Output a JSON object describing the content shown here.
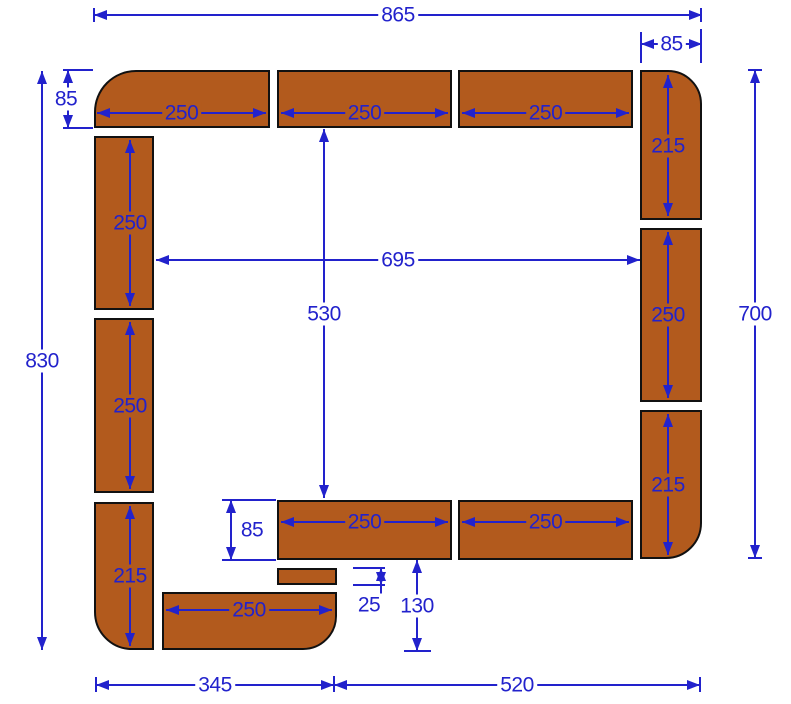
{
  "diagram": {
    "description": "Dimensioned cutting/layout plan of rectangular edging pieces forming an open rectangular border",
    "canvas": {
      "width": 791,
      "height": 704,
      "background": "#ffffff"
    },
    "colors": {
      "piece_fill": "#b25a1d",
      "piece_border": "#111111",
      "dimension": "#2222cc",
      "background": "#ffffff"
    },
    "pieces": [
      {
        "id": "top-left-corner-piece",
        "x": 94,
        "y": 70,
        "w": 176,
        "h": 58,
        "corner": "tl",
        "r": 42
      },
      {
        "id": "top-piece-1",
        "x": 277,
        "y": 70,
        "w": 175,
        "h": 58,
        "corner": "",
        "r": 0
      },
      {
        "id": "top-piece-2",
        "x": 458,
        "y": 70,
        "w": 175,
        "h": 58,
        "corner": "",
        "r": 0
      },
      {
        "id": "right-top-corner-piece",
        "x": 640,
        "y": 70,
        "w": 62,
        "h": 150,
        "corner": "tr",
        "r": 34
      },
      {
        "id": "right-middle-piece",
        "x": 640,
        "y": 228,
        "w": 62,
        "h": 174,
        "corner": "",
        "r": 0
      },
      {
        "id": "right-bottom-corner-piece",
        "x": 640,
        "y": 410,
        "w": 62,
        "h": 149,
        "corner": "br",
        "r": 36
      },
      {
        "id": "left-piece-1",
        "x": 94,
        "y": 136,
        "w": 60,
        "h": 174,
        "corner": "",
        "r": 0
      },
      {
        "id": "left-piece-2",
        "x": 94,
        "y": 318,
        "w": 60,
        "h": 175,
        "corner": "",
        "r": 0
      },
      {
        "id": "left-bottom-corner-piece",
        "x": 94,
        "y": 502,
        "w": 60,
        "h": 148,
        "corner": "bl",
        "r": 38
      },
      {
        "id": "bottom-piece-1",
        "x": 277,
        "y": 500,
        "w": 175,
        "h": 60,
        "corner": "",
        "r": 0
      },
      {
        "id": "bottom-piece-2",
        "x": 458,
        "y": 500,
        "w": 175,
        "h": 60,
        "corner": "",
        "r": 0
      },
      {
        "id": "small-spacer-piece",
        "x": 277,
        "y": 568,
        "w": 60,
        "h": 17,
        "corner": "",
        "r": 0
      },
      {
        "id": "bottom-left-end-piece",
        "x": 162,
        "y": 592,
        "w": 175,
        "h": 58,
        "corner": "br",
        "r": 34
      }
    ],
    "dims": [
      {
        "id": "overall-width",
        "label": "865",
        "dir": "h",
        "at": 15,
        "from": 94,
        "to": 702,
        "bg": "white"
      },
      {
        "id": "corner-width",
        "label": "85",
        "dir": "h",
        "at": 44,
        "from": 641,
        "to": 702,
        "bg": "white"
      },
      {
        "id": "corner-height",
        "label": "85",
        "dir": "v",
        "at": 68,
        "from": 70,
        "to": 128,
        "bg": "white",
        "tdx": -2
      },
      {
        "id": "overall-height",
        "label": "830",
        "dir": "v",
        "at": 42,
        "from": 71,
        "to": 650,
        "bg": "white"
      },
      {
        "id": "right-height",
        "label": "700",
        "dir": "v",
        "at": 755,
        "from": 70,
        "to": 558,
        "bg": "white"
      },
      {
        "id": "inner-width",
        "label": "695",
        "dir": "h",
        "at": 260,
        "from": 156,
        "to": 640,
        "bg": "white"
      },
      {
        "id": "inner-height",
        "label": "530",
        "dir": "v",
        "at": 324,
        "from": 129,
        "to": 498,
        "bg": "white"
      },
      {
        "id": "edge-height",
        "label": "85",
        "dir": "v",
        "at": 231,
        "from": 500,
        "to": 560,
        "bg": "white",
        "tdx": 21
      },
      {
        "id": "spacer-thickness",
        "label": "25",
        "dir": "v",
        "at": 381,
        "from": 568,
        "to": 585,
        "bg": "white",
        "tdx": -12,
        "tdy": 28
      },
      {
        "id": "opening-height",
        "label": "130",
        "dir": "v",
        "at": 417,
        "from": 560,
        "to": 651,
        "bg": "white"
      },
      {
        "id": "bottom-left-width",
        "label": "345",
        "dir": "h",
        "at": 685,
        "from": 96,
        "to": 334,
        "bg": "white"
      },
      {
        "id": "bottom-right-width",
        "label": "520",
        "dir": "h",
        "at": 685,
        "from": 334,
        "to": 700,
        "bg": "white"
      },
      {
        "id": "len-top-1",
        "label": "250",
        "dir": "h",
        "at": 113,
        "from": 97,
        "to": 266,
        "bg": "brown"
      },
      {
        "id": "len-top-2",
        "label": "250",
        "dir": "h",
        "at": 113,
        "from": 281,
        "to": 448,
        "bg": "brown"
      },
      {
        "id": "len-top-3",
        "label": "250",
        "dir": "h",
        "at": 113,
        "from": 462,
        "to": 629,
        "bg": "brown"
      },
      {
        "id": "len-right-1",
        "label": "215",
        "dir": "v",
        "at": 668,
        "from": 75,
        "to": 216,
        "bg": "brown"
      },
      {
        "id": "len-right-2",
        "label": "250",
        "dir": "v",
        "at": 668,
        "from": 232,
        "to": 398,
        "bg": "brown"
      },
      {
        "id": "len-right-3",
        "label": "215",
        "dir": "v",
        "at": 668,
        "from": 414,
        "to": 555,
        "bg": "brown"
      },
      {
        "id": "len-left-1",
        "label": "250",
        "dir": "v",
        "at": 130,
        "from": 140,
        "to": 306,
        "bg": "brown"
      },
      {
        "id": "len-left-2",
        "label": "250",
        "dir": "v",
        "at": 130,
        "from": 322,
        "to": 489,
        "bg": "brown"
      },
      {
        "id": "len-left-3",
        "label": "215",
        "dir": "v",
        "at": 130,
        "from": 506,
        "to": 646,
        "bg": "brown"
      },
      {
        "id": "len-bottom-1",
        "label": "250",
        "dir": "h",
        "at": 522,
        "from": 281,
        "to": 448,
        "bg": "brown"
      },
      {
        "id": "len-bottom-2",
        "label": "250",
        "dir": "h",
        "at": 522,
        "from": 462,
        "to": 629,
        "bg": "brown"
      },
      {
        "id": "len-bottom-left",
        "label": "250",
        "dir": "h",
        "at": 610,
        "from": 166,
        "to": 332,
        "bg": "brown"
      }
    ],
    "extension_lines": [
      {
        "x": 93,
        "y": 8,
        "w": 2,
        "h": 14
      },
      {
        "x": 700,
        "y": 8,
        "w": 2,
        "h": 14
      },
      {
        "x": 640,
        "y": 32,
        "w": 2,
        "h": 31
      },
      {
        "x": 700,
        "y": 29,
        "w": 2,
        "h": 34
      },
      {
        "x": 63,
        "y": 69,
        "w": 30,
        "h": 2
      },
      {
        "x": 63,
        "y": 127,
        "w": 30,
        "h": 2
      },
      {
        "x": 748,
        "y": 69,
        "w": 14,
        "h": 2
      },
      {
        "x": 748,
        "y": 557,
        "w": 14,
        "h": 2
      },
      {
        "x": 222,
        "y": 499,
        "w": 54,
        "h": 2
      },
      {
        "x": 222,
        "y": 559,
        "w": 54,
        "h": 2
      },
      {
        "x": 353,
        "y": 567,
        "w": 32,
        "h": 2
      },
      {
        "x": 353,
        "y": 584,
        "w": 32,
        "h": 2
      },
      {
        "x": 380,
        "y": 584,
        "w": 2,
        "h": 15
      },
      {
        "x": 404,
        "y": 650,
        "w": 27,
        "h": 2
      },
      {
        "x": 95,
        "y": 677,
        "w": 2,
        "h": 15
      },
      {
        "x": 333,
        "y": 676,
        "w": 2,
        "h": 16
      },
      {
        "x": 699,
        "y": 677,
        "w": 2,
        "h": 15
      }
    ]
  }
}
